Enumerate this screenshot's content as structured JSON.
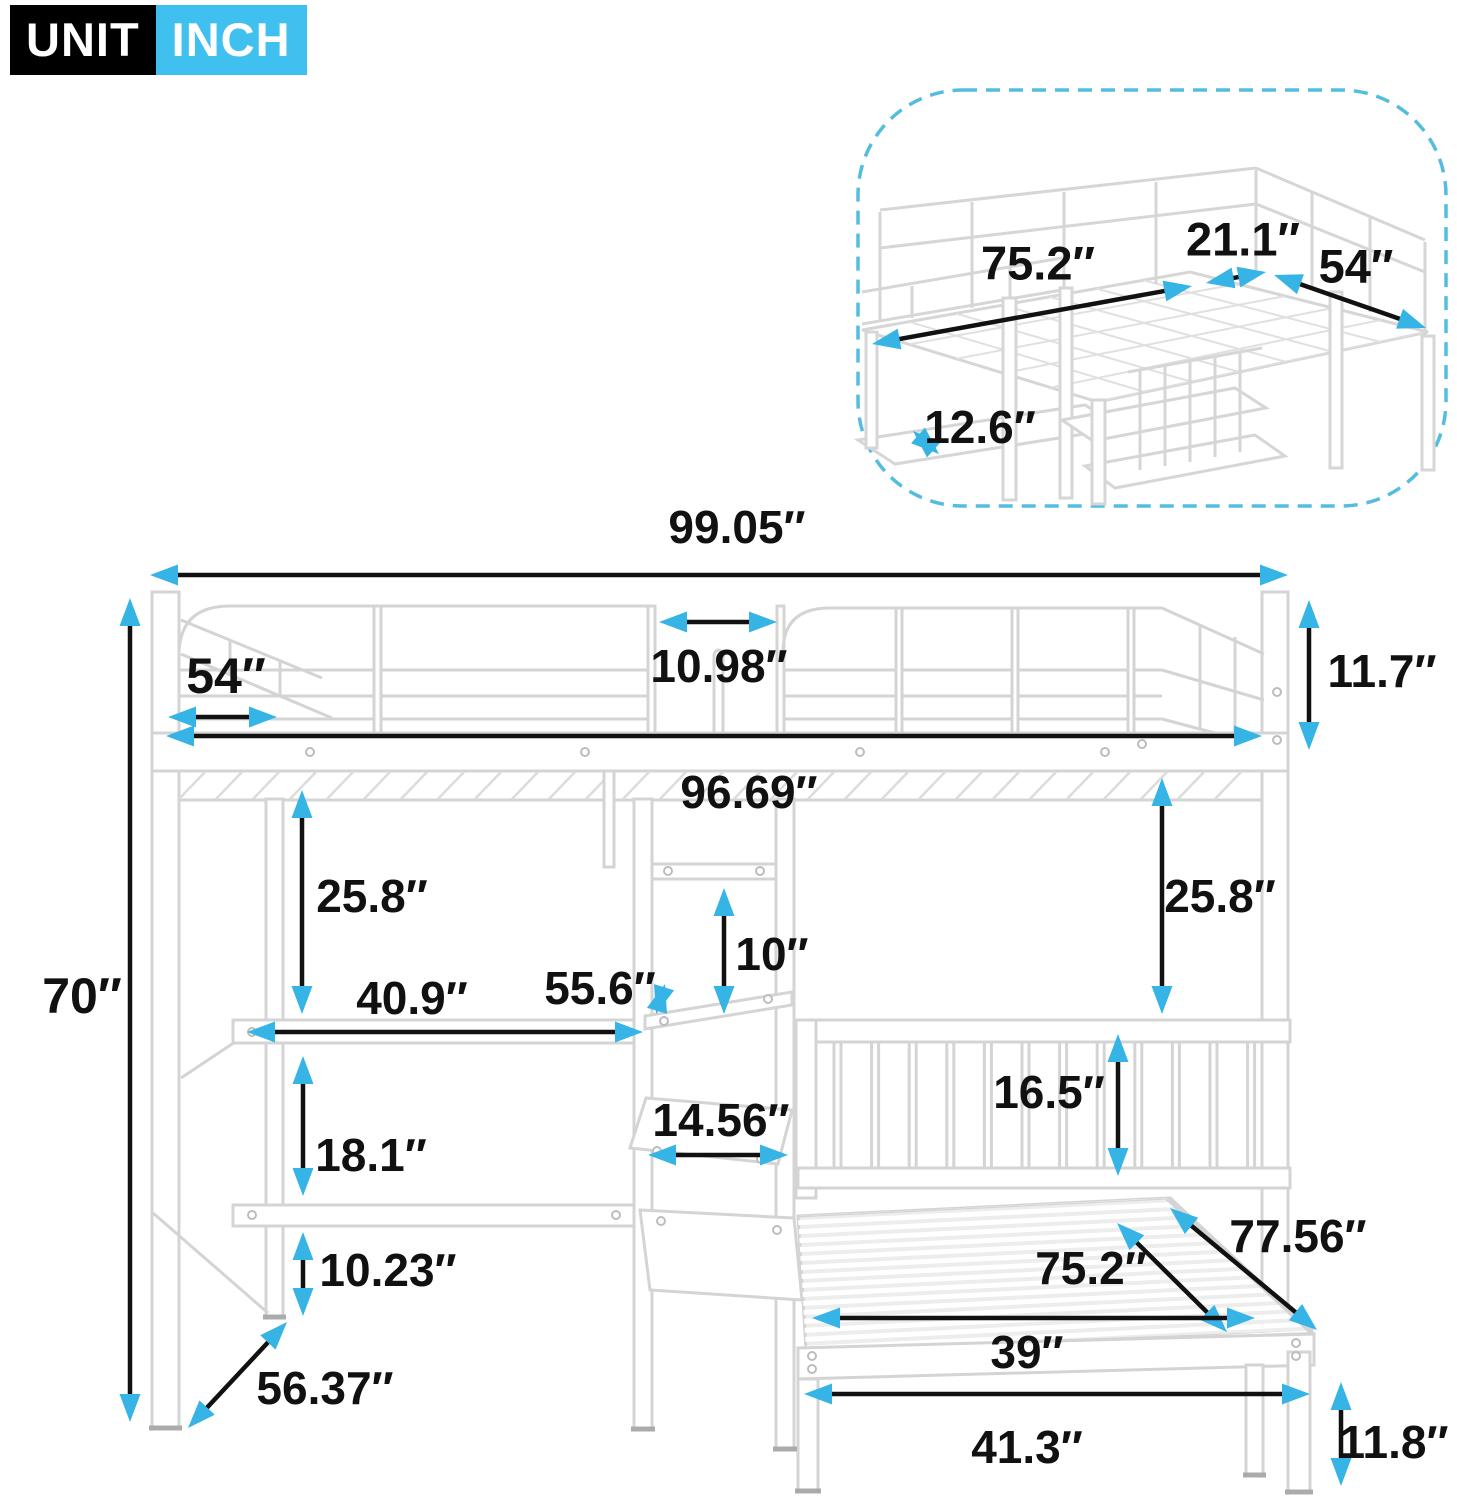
{
  "badge": {
    "unit": "UNIT",
    "value": "INCH"
  },
  "colors": {
    "arrow": "#36b4e5",
    "text": "#111111",
    "badge_accent": "#3fc0ef",
    "inset_border": "#54bddf",
    "frame": "#d4d4d4"
  },
  "inset_dimensions": [
    {
      "id": "inset-length",
      "label": "75.2″",
      "line": [
        872,
        344,
        1192,
        286
      ],
      "label_pos": [
        1038,
        263
      ],
      "font_size": 47
    },
    {
      "id": "inset-gap",
      "label": "21.1″",
      "line": [
        1206,
        283,
        1266,
        272
      ],
      "label_pos": [
        1243,
        239
      ],
      "font_size": 47
    },
    {
      "id": "inset-width",
      "label": "54″",
      "line": [
        1274,
        275,
        1426,
        328
      ],
      "label_pos": [
        1356,
        266
      ],
      "font_size": 47
    },
    {
      "id": "inset-shelf-depth",
      "label": "12.6″",
      "line": [
        913,
        431,
        939,
        454
      ],
      "label_pos": [
        980,
        427
      ],
      "font_size": 46
    }
  ],
  "main_dimensions": [
    {
      "id": "overall-width",
      "label": "99.05″",
      "line": [
        150,
        575,
        1288,
        575
      ],
      "label_pos": [
        737,
        527
      ],
      "font_size": 46
    },
    {
      "id": "top-left-width",
      "label": "54″",
      "line": [
        168,
        717,
        277,
        717
      ],
      "label_pos": [
        226,
        676
      ],
      "font_size": 50
    },
    {
      "id": "rail-gap",
      "label": "10.98″",
      "line": [
        659,
        622,
        777,
        622
      ],
      "label_pos": [
        719,
        666
      ],
      "font_size": 46
    },
    {
      "id": "guardrail-height",
      "label": "11.7″",
      "line": [
        1309,
        600,
        1309,
        750
      ],
      "label_pos": [
        1382,
        671
      ],
      "font_size": 46
    },
    {
      "id": "inner-width",
      "label": "96.69″",
      "line": [
        166,
        736,
        1262,
        736
      ],
      "label_pos": [
        749,
        792
      ],
      "font_size": 46
    },
    {
      "id": "overall-height",
      "label": "70″",
      "line": [
        130,
        598,
        130,
        1422
      ],
      "label_pos": [
        82,
        996
      ],
      "font_size": 50
    },
    {
      "id": "clearance-left",
      "label": "25.8″",
      "line": [
        302,
        790,
        302,
        1014
      ],
      "label_pos": [
        372,
        896
      ],
      "font_size": 46
    },
    {
      "id": "clearance-right",
      "label": "25.8″",
      "line": [
        1162,
        778,
        1162,
        1014
      ],
      "label_pos": [
        1220,
        896
      ],
      "font_size": 46
    },
    {
      "id": "shelf-spacing",
      "label": "10″",
      "line": [
        724,
        888,
        724,
        1014
      ],
      "label_pos": [
        772,
        954
      ],
      "font_size": 46
    },
    {
      "id": "desk-width",
      "label": "40.9″",
      "line": [
        247,
        1032,
        643,
        1032
      ],
      "label_pos": [
        412,
        998
      ],
      "font_size": 46
    },
    {
      "id": "shelf-height",
      "label": "55.6″",
      "line": [
        656,
        1014,
        665,
        984
      ],
      "label_pos": [
        600,
        988
      ],
      "font_size": 46
    },
    {
      "id": "desk-to-shelf",
      "label": "18.1″",
      "line": [
        303,
        1056,
        303,
        1196
      ],
      "label_pos": [
        371,
        1155
      ],
      "font_size": 46
    },
    {
      "id": "shelf-width",
      "label": "14.56″",
      "line": [
        648,
        1155,
        788,
        1155
      ],
      "label_pos": [
        721,
        1120
      ],
      "font_size": 46
    },
    {
      "id": "headboard-height",
      "label": "16.5″",
      "line": [
        1118,
        1034,
        1118,
        1176
      ],
      "label_pos": [
        1049,
        1092
      ],
      "font_size": 46
    },
    {
      "id": "lower-gap",
      "label": "10.23″",
      "line": [
        303,
        1232,
        303,
        1316
      ],
      "label_pos": [
        388,
        1270
      ],
      "font_size": 46
    },
    {
      "id": "floor-diagonal",
      "label": "56.37″",
      "line": [
        287,
        1322,
        188,
        1428
      ],
      "label_pos": [
        325,
        1388
      ],
      "font_size": 46
    },
    {
      "id": "bed-length",
      "label": "75.2″",
      "line": [
        1117,
        1223,
        1227,
        1332
      ],
      "label_pos": [
        1091,
        1268
      ],
      "font_size": 46
    },
    {
      "id": "bed-diagonal",
      "label": "77.56″",
      "line": [
        1170,
        1208,
        1317,
        1330
      ],
      "label_pos": [
        1298,
        1236
      ],
      "font_size": 46
    },
    {
      "id": "bed-width",
      "label": "39″",
      "line": [
        812,
        1318,
        1255,
        1318
      ],
      "label_pos": [
        1027,
        1352
      ],
      "font_size": 46
    },
    {
      "id": "base-width",
      "label": "41.3″",
      "line": [
        804,
        1394,
        1310,
        1394
      ],
      "label_pos": [
        1027,
        1447
      ],
      "font_size": 46
    },
    {
      "id": "leg-height",
      "label": "11.8″",
      "line": [
        1341,
        1382,
        1341,
        1486
      ],
      "label_pos": [
        1394,
        1442
      ],
      "font_size": 46
    }
  ]
}
